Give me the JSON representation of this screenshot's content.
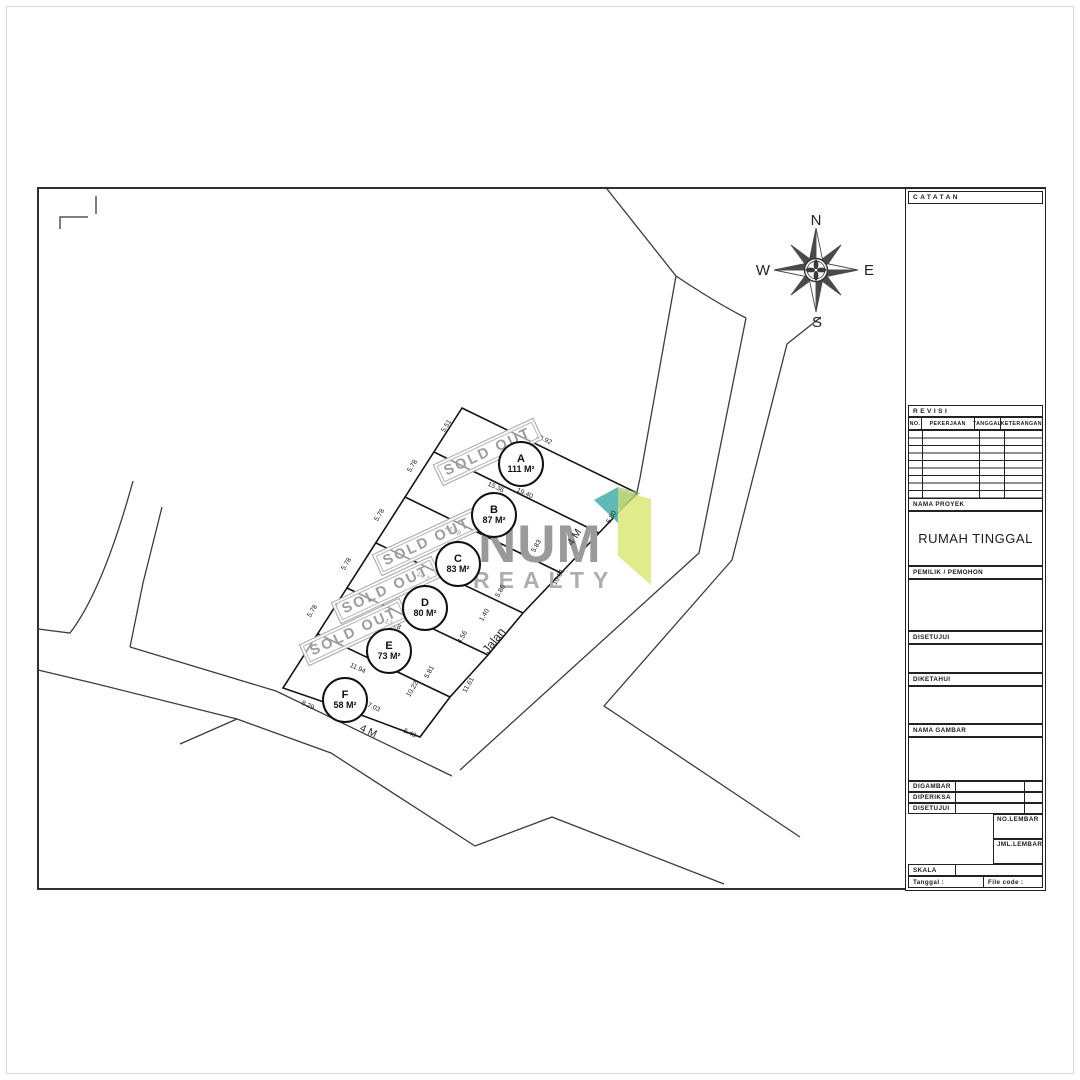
{
  "sheet": {
    "watermark": {
      "line1": "NUM",
      "line2": "REALTY",
      "accent_teal": "#49b1ae",
      "accent_green": "#dcea7c"
    },
    "compass": {
      "n": "N",
      "e": "E",
      "s": "S",
      "w": "W"
    },
    "stamp_text": "SOLD OUT",
    "stamps": [
      {
        "x": 488,
        "y": 452
      },
      {
        "x": 427,
        "y": 542
      },
      {
        "x": 386,
        "y": 590
      },
      {
        "x": 354,
        "y": 632
      }
    ],
    "plots": [
      {
        "id": "A",
        "area": "111 M²",
        "x": 521,
        "y": 464
      },
      {
        "id": "B",
        "area": "87 M²",
        "x": 494,
        "y": 515
      },
      {
        "id": "C",
        "area": "83 M²",
        "x": 458,
        "y": 564
      },
      {
        "id": "D",
        "area": "80 M²",
        "x": 425,
        "y": 608
      },
      {
        "id": "E",
        "area": "73 M²",
        "x": 389,
        "y": 651
      },
      {
        "id": "F",
        "area": "58 M²",
        "x": 345,
        "y": 700
      }
    ],
    "dimensions": [
      {
        "t": "5.51",
        "x": 448,
        "y": 427,
        "r": -58
      },
      {
        "t": "5.78",
        "x": 414,
        "y": 467,
        "r": -58
      },
      {
        "t": "5.78",
        "x": 381,
        "y": 516,
        "r": -58
      },
      {
        "t": "5.78",
        "x": 348,
        "y": 565,
        "r": -58
      },
      {
        "t": "5.78",
        "x": 314,
        "y": 612,
        "r": -58
      },
      {
        "t": "19.92",
        "x": 543,
        "y": 441,
        "r": 25
      },
      {
        "t": "15.36",
        "x": 495,
        "y": 489,
        "r": 25
      },
      {
        "t": "19.40",
        "x": 524,
        "y": 495,
        "r": 25
      },
      {
        "t": "14.98",
        "x": 452,
        "y": 532,
        "r": 25
      },
      {
        "t": "14.37",
        "x": 424,
        "y": 579,
        "r": 25
      },
      {
        "t": "13.28",
        "x": 392,
        "y": 626,
        "r": 25
      },
      {
        "t": "11.94",
        "x": 357,
        "y": 670,
        "r": 25
      },
      {
        "t": "8.29",
        "x": 307,
        "y": 707,
        "r": 25
      },
      {
        "t": "7.03",
        "x": 373,
        "y": 709,
        "r": 25
      },
      {
        "t": "5.40",
        "x": 409,
        "y": 735,
        "r": 25
      },
      {
        "t": "5.80",
        "x": 613,
        "y": 518,
        "r": -60
      },
      {
        "t": "5.83",
        "x": 538,
        "y": 547,
        "r": -60
      },
      {
        "t": "5.86",
        "x": 502,
        "y": 592,
        "r": -60
      },
      {
        "t": "1.40",
        "x": 486,
        "y": 616,
        "r": -60
      },
      {
        "t": "4.56",
        "x": 464,
        "y": 638,
        "r": -60
      },
      {
        "t": "5.81",
        "x": 431,
        "y": 673,
        "r": -60
      },
      {
        "t": "10.22",
        "x": 414,
        "y": 690,
        "r": -60
      },
      {
        "t": "10.81",
        "x": 560,
        "y": 578,
        "r": -60
      },
      {
        "t": "11.61",
        "x": 470,
        "y": 686,
        "r": -60
      }
    ],
    "road_labels": [
      {
        "t": "Jalan",
        "x": 497,
        "y": 643,
        "r": -52,
        "s": 12
      },
      {
        "t": "4 M",
        "x": 577,
        "y": 539,
        "r": -57,
        "s": 10.5
      },
      {
        "t": "4 M",
        "x": 367,
        "y": 734,
        "r": 25,
        "s": 10.5
      }
    ],
    "title_block": {
      "catatan": "CATATAN",
      "revisi": "REVISI",
      "rev_cols": [
        "NO.",
        "PEKERJAAN",
        "TANGGAL",
        "KETERANGAN"
      ],
      "nama_proyek_label": "NAMA PROYEK",
      "nama_proyek": "RUMAH TINGGAL",
      "pemilik": "PEMILIK / PEMOHON",
      "disetujui": "DISETUJUI",
      "diketahui": "DIKETAHUI",
      "nama_gambar": "NAMA GAMBAR",
      "digambar": "DIGAMBAR",
      "diperiksa": "DIPERIKSA",
      "disetujui2": "DISETUJUI",
      "no_lembar": "NO.LEMBAR",
      "jml_lembar": "JML.LEMBAR",
      "skala": "SKALA",
      "tanggal": "Tanggal :",
      "file_code": "File code :"
    }
  }
}
